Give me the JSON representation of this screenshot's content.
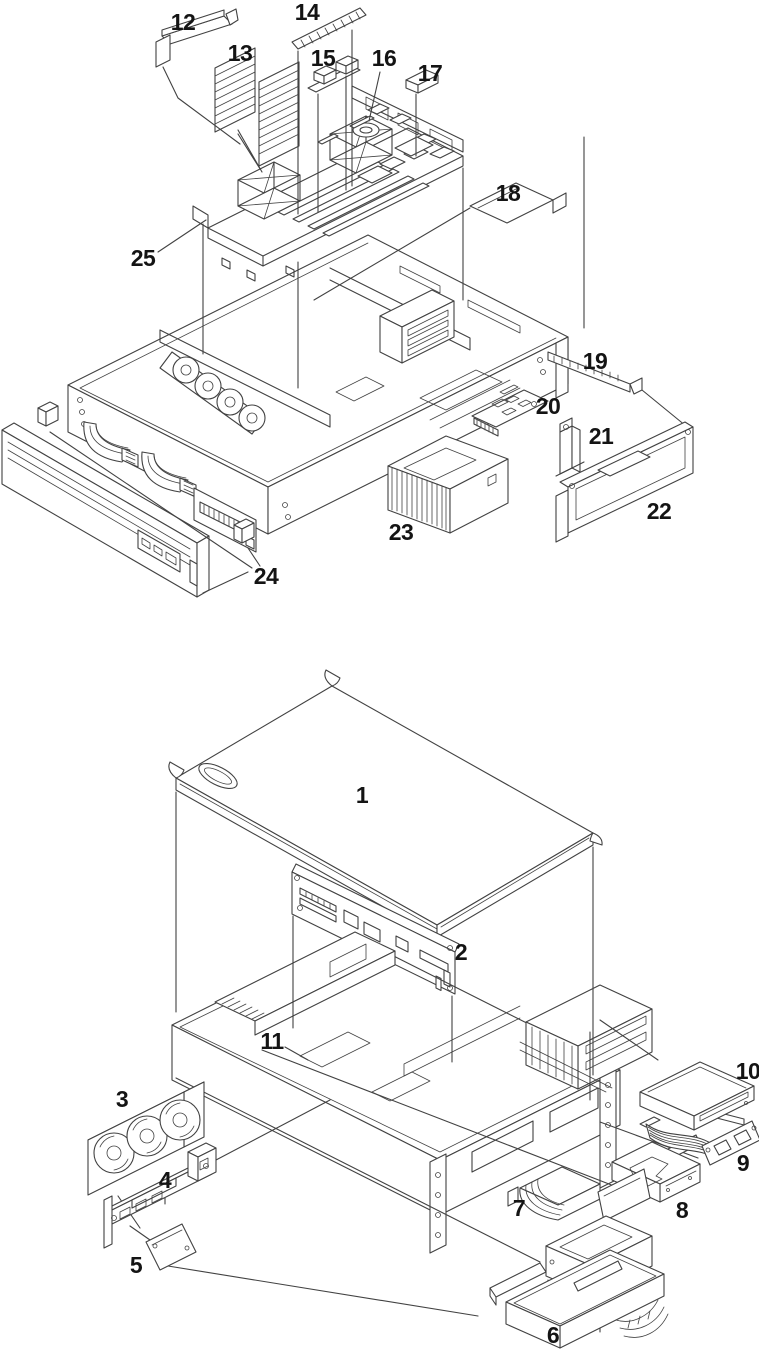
{
  "page": {
    "background": "#ffffff",
    "line_color": "#424242",
    "label_color": "#141414"
  },
  "figures": [
    {
      "name": "server-internals-exploded-view",
      "callouts": [
        {
          "label": "12",
          "x": 183,
          "y": 22
        },
        {
          "label": "13",
          "x": 240,
          "y": 53
        },
        {
          "label": "14",
          "x": 307,
          "y": 12
        },
        {
          "label": "15",
          "x": 323,
          "y": 58
        },
        {
          "label": "16",
          "x": 384,
          "y": 58
        },
        {
          "label": "17",
          "x": 430,
          "y": 73
        },
        {
          "label": "18",
          "x": 508,
          "y": 193
        },
        {
          "label": "19",
          "x": 595,
          "y": 361
        },
        {
          "label": "20",
          "x": 548,
          "y": 406
        },
        {
          "label": "21",
          "x": 601,
          "y": 436
        },
        {
          "label": "22",
          "x": 659,
          "y": 511
        },
        {
          "label": "23",
          "x": 401,
          "y": 532
        },
        {
          "label": "24",
          "x": 266,
          "y": 576
        },
        {
          "label": "25",
          "x": 143,
          "y": 258
        }
      ]
    },
    {
      "name": "server-chassis-cover-and-drives-exploded-view",
      "callouts": [
        {
          "label": "1",
          "x": 362,
          "y": 795
        },
        {
          "label": "2",
          "x": 461,
          "y": 952
        },
        {
          "label": "3",
          "x": 122,
          "y": 1099
        },
        {
          "label": "4",
          "x": 165,
          "y": 1180
        },
        {
          "label": "5",
          "x": 136,
          "y": 1265
        },
        {
          "label": "6",
          "x": 553,
          "y": 1335
        },
        {
          "label": "7",
          "x": 519,
          "y": 1208
        },
        {
          "label": "8",
          "x": 682,
          "y": 1210
        },
        {
          "label": "9",
          "x": 743,
          "y": 1163
        },
        {
          "label": "10",
          "x": 748,
          "y": 1071
        },
        {
          "label": "11",
          "x": 272,
          "y": 1041
        }
      ]
    }
  ]
}
